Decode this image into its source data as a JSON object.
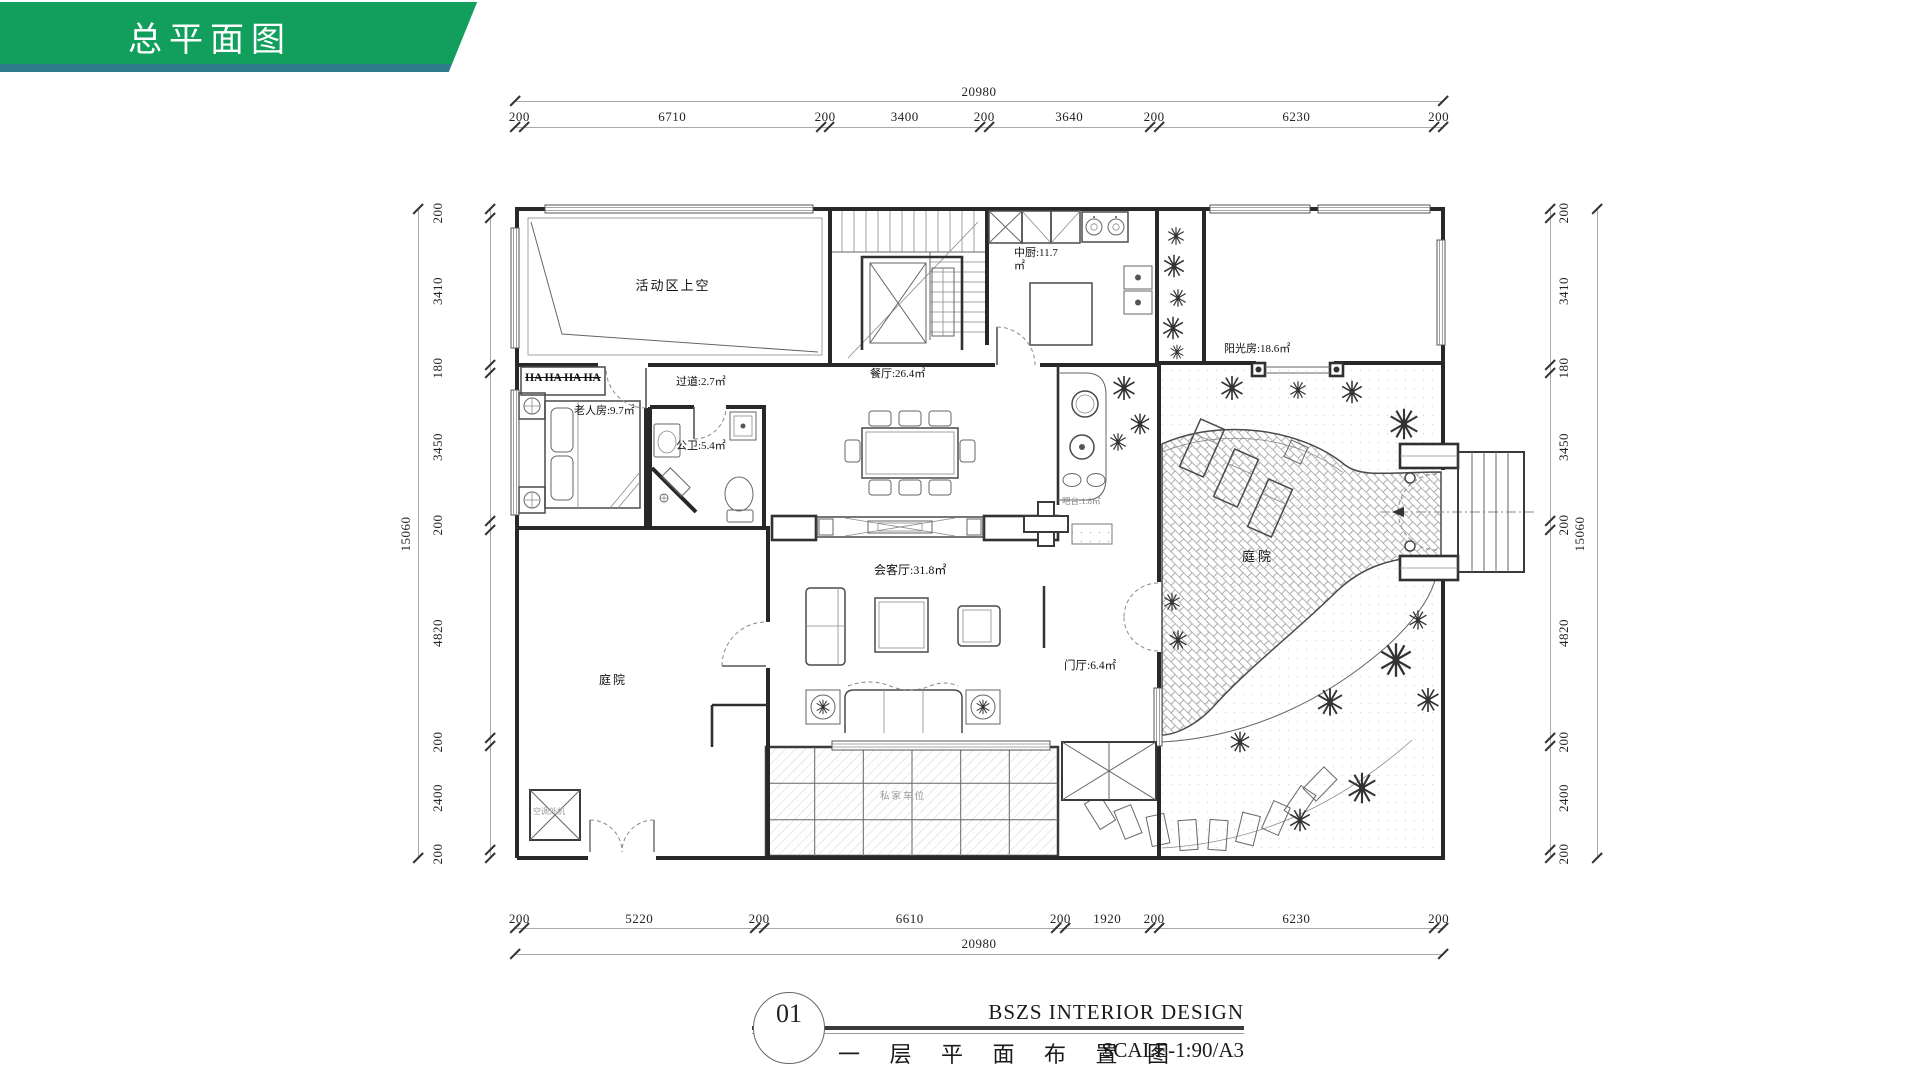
{
  "header": {
    "title": "总平面图"
  },
  "colors": {
    "banner_green": "#129f5d",
    "banner_underline_teal": "#2e7b8c"
  },
  "title_block": {
    "number": "01",
    "drawing_title": "一 层 平 面 布 置 图",
    "studio": "BSZS  INTERIOR DESIGN",
    "scale": "SCALE-1:90/A3"
  },
  "dimensions": {
    "top": {
      "total": "20980",
      "segments": [
        "200",
        "6710",
        "200",
        "3400",
        "200",
        "3640",
        "200",
        "6230",
        "200"
      ]
    },
    "bottom": {
      "total": "20980",
      "segments": [
        "200",
        "5220",
        "200",
        "6610",
        "200",
        "1920",
        "200",
        "6230",
        "200"
      ]
    },
    "left": {
      "total": "15060",
      "segments": [
        "200",
        "3410",
        "180",
        "3450",
        "200",
        "4820",
        "200",
        "2400",
        "200"
      ]
    },
    "right": {
      "total": "15060",
      "segments": [
        "200",
        "3410",
        "180",
        "3450",
        "200",
        "4820",
        "200",
        "2400",
        "200"
      ]
    }
  },
  "rooms": {
    "void_area": "活动区上空",
    "kitchen": "中厨:11.7",
    "kitchen_unit": "㎡",
    "sunroom": "阳光房:18.6㎡",
    "dining": "餐厅:26.4㎡",
    "corridor": "过道:2.7㎡",
    "elder_room": "老人房:9.7㎡",
    "bath": "公卫:5.4㎡",
    "living": "会客厅:31.8㎡",
    "foyer": "门厅:6.4㎡",
    "bar": "吧台:1.8㎡",
    "courtyard": "庭院",
    "side_yard": "庭院",
    "parking": "私家车位",
    "wardrobe": "HA HA HA HA",
    "ac_unit": "空调外机"
  }
}
